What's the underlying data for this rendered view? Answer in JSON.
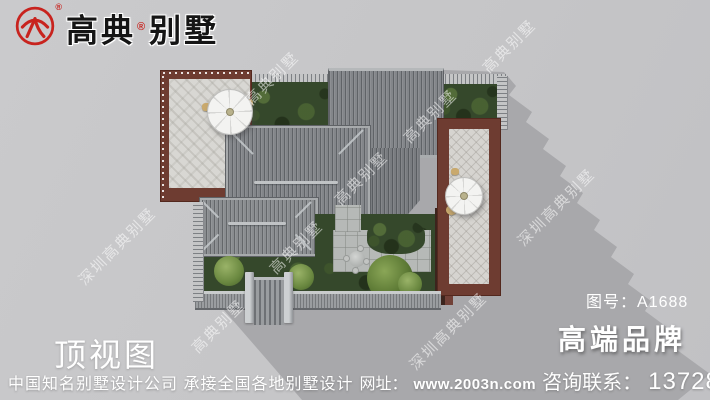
{
  "colors": {
    "accent_red": "#c8231e",
    "background_gray": "#c6c6c8",
    "shadow_gray": "#a8a8ab",
    "roof_gray": "#83868a",
    "walkway_maroon": "#6e3c31",
    "foliage_green": "#35482b",
    "text_white": "#ffffff"
  },
  "header": {
    "brand_part1": "高典",
    "brand_reg": "®",
    "brand_part2": "别墅",
    "seal_reg": "®"
  },
  "plan": {
    "view_label": "顶视图",
    "drawing_no_label": "图号：",
    "drawing_no_value": "A1688",
    "slogan": "高端品牌"
  },
  "footer": {
    "company_line": "中国知名别墅设计公司 承接全国各地别墅设计",
    "site_label": "网址：",
    "site_url": "www.2003n.com",
    "contact_label": "咨询联系：",
    "phone": "13728966966"
  },
  "watermarks": [
    {
      "text": "高典别墅",
      "x": 509,
      "y": 46
    },
    {
      "text": "高典别墅",
      "x": 430,
      "y": 116
    },
    {
      "text": "高典别墅",
      "x": 361,
      "y": 178
    },
    {
      "text": "高典别墅",
      "x": 296,
      "y": 247
    },
    {
      "text": "高典别墅",
      "x": 218,
      "y": 326
    },
    {
      "text": "高典别墅",
      "x": 272,
      "y": 78
    },
    {
      "text": "深圳高典别墅",
      "x": 556,
      "y": 207
    },
    {
      "text": "深圳高典别墅",
      "x": 448,
      "y": 331
    },
    {
      "text": "深圳高典别墅",
      "x": 117,
      "y": 246
    }
  ]
}
